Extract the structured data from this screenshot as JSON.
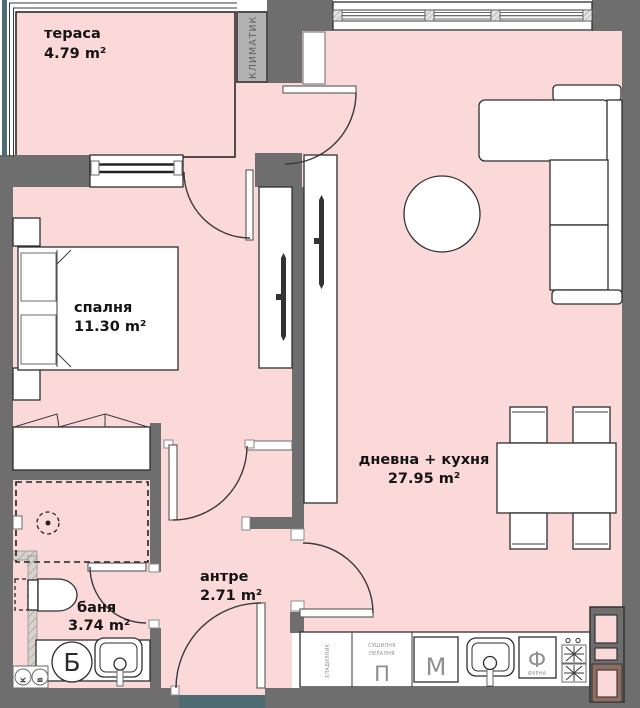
{
  "plan_title": "One-bedroom apartment floor plan",
  "rooms": {
    "terrace": {
      "name": "тераса",
      "area": "4.79 m²"
    },
    "bedroom": {
      "name": "спалня",
      "area": "11.30 m²"
    },
    "living_kitchen": {
      "name": "дневна + кухня",
      "area": "27.95 m²"
    },
    "hallway": {
      "name": "антре",
      "area": "2.71 m²"
    },
    "bathroom": {
      "name": "баня",
      "area": "3.74 m²"
    }
  },
  "equipment": {
    "ac_unit": "КЛИМАТИК",
    "fridge": "ХЛАДИЛНИК",
    "dryer": "СУШИЛНЯ",
    "washer": "ПЕРАЛНЯ",
    "washer_letter": "П",
    "dishwasher_letter": "М",
    "oven_letter": "Ф",
    "oven": "ФУРНА",
    "boiler_letter": "Б",
    "riser_cold": "К",
    "riser_hot": "В"
  },
  "colors": {
    "floor": "#fcd9d9",
    "wall": "#6e6e6e",
    "teal": "#4d6b70",
    "brown": "#8d6e62"
  }
}
